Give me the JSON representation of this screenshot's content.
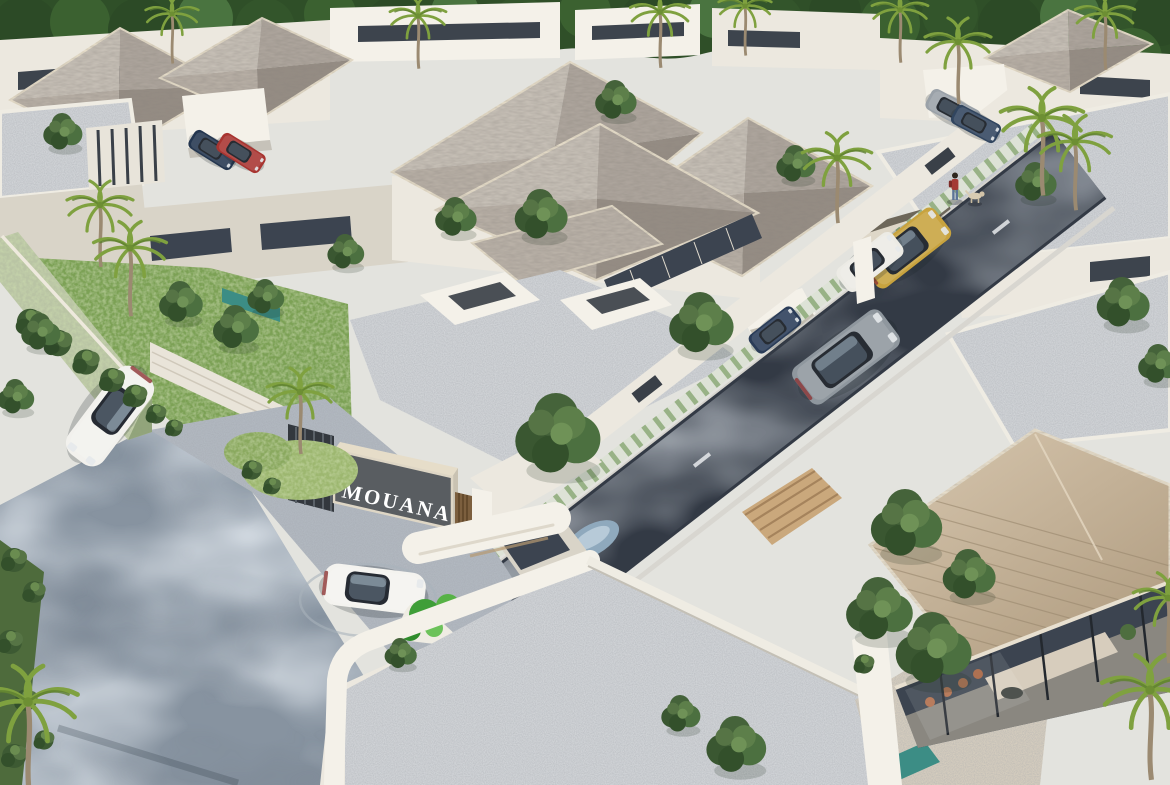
{
  "scene": {
    "title": "MOUANA",
    "type": "aerial 3D architectural rendering",
    "description": "Bird's-eye view of a gated tropical villa compound: modern white villas with grey shingle hip roofs and gravel flat roofs, a dark asphalt internal street with green-tiled sidewalk, a landscaped entrance gate with MOUANA sign and guard canopy, lawns, palms, trees and luxury cars."
  },
  "sign": {
    "text": "MOUANA"
  },
  "entities": {
    "entrance": "gate with dark slatted MOUANA sign panel, bronze louvre door, guard booth under rounded white canopy, bright green planter and circular paver pad",
    "street": "dark asphalt internal street with white lane dashes and green-white patterned sidewalk",
    "approach_road": "mottled blue-grey asphalt approach road at lower left with sculpted shrub balls and a green-mosaic feature wall",
    "villas": "modern white villas: grey shingle hip roofs, white-gravel flat roofs, floor-to-ceiling glass walls",
    "interior_view": "corner villa at lower right shows living room through glass: cream sofa, terracotta dining chairs, plants",
    "pedestrian": "person in red top with backpack walking a light-coloured dog on the sidewalk",
    "water": "teal-tiled pond strip beside left villa, small teal pool at lower right"
  },
  "cars": [
    {
      "type": "sport",
      "x": 110,
      "y": 416,
      "rot": 127,
      "s": 1.0,
      "color": "#f2f1ed",
      "label": "white sports car on approach road"
    },
    {
      "type": "sport",
      "x": 374,
      "y": 589,
      "rot": 7,
      "s": 0.95,
      "color": "#f4f3ef",
      "label": "white sports car at entrance gate"
    },
    {
      "type": "suv",
      "x": 846,
      "y": 357,
      "rot": -37,
      "s": 0.95,
      "color": "#8f979e",
      "label": "silver SUV driving on internal street"
    },
    {
      "type": "suv",
      "x": 906,
      "y": 248,
      "rot": -38,
      "s": 0.8,
      "color": "#c8a33e",
      "label": "gold SUV parked at villa entrance bay"
    },
    {
      "type": "sedan",
      "x": 870,
      "y": 262,
      "rot": -38,
      "s": 0.7,
      "color": "#ecebe5",
      "label": "white sedan beside gold SUV"
    },
    {
      "type": "sedan",
      "x": 775,
      "y": 330,
      "rot": -38,
      "s": 0.55,
      "color": "#2a3c58",
      "label": "dark car in mid carport"
    },
    {
      "type": "sedan",
      "x": 213,
      "y": 150,
      "rot": 32,
      "s": 0.5,
      "color": "#24364f",
      "label": "dark blue car in north carport"
    },
    {
      "type": "sedan",
      "x": 241,
      "y": 153,
      "rot": 32,
      "s": 0.5,
      "color": "#a83430",
      "label": "red car in north carport"
    },
    {
      "type": "sedan",
      "x": 953,
      "y": 110,
      "rot": 28,
      "s": 0.55,
      "color": "#9aa1a8",
      "label": "silver car in northeast carport"
    },
    {
      "type": "sedan",
      "x": 976,
      "y": 124,
      "rot": 28,
      "s": 0.5,
      "color": "#31455f",
      "label": "blue car in northeast carport"
    }
  ],
  "layout": {
    "trees": [
      [
        62,
        130,
        0.85
      ],
      [
        615,
        98,
        0.9
      ],
      [
        540,
        212,
        1.15
      ],
      [
        795,
        162,
        0.85
      ],
      [
        556,
        430,
        1.85
      ],
      [
        700,
        320,
        1.4
      ],
      [
        905,
        520,
        1.55
      ],
      [
        1122,
        300,
        1.15
      ],
      [
        1158,
        362,
        0.9
      ],
      [
        735,
        742,
        1.3
      ],
      [
        680,
        712,
        0.85
      ],
      [
        400,
        652,
        0.7
      ],
      [
        878,
        606,
        1.45
      ],
      [
        932,
        645,
        1.65
      ],
      [
        968,
        572,
        1.15
      ],
      [
        180,
        300,
        0.95
      ],
      [
        235,
        325,
        1.0
      ],
      [
        265,
        295,
        0.8
      ],
      [
        40,
        330,
        0.85
      ],
      [
        15,
        395,
        0.8
      ],
      [
        1035,
        180,
        0.9
      ],
      [
        345,
        250,
        0.8
      ],
      [
        455,
        215,
        0.9
      ]
    ],
    "palms": [
      [
        100,
        205,
        1.0
      ],
      [
        130,
        248,
        1.1
      ],
      [
        300,
        392,
        1.0
      ],
      [
        418,
        16,
        0.85
      ],
      [
        660,
        12,
        0.9
      ],
      [
        745,
        6,
        0.8
      ],
      [
        900,
        10,
        0.85
      ],
      [
        837,
        158,
        1.05
      ],
      [
        958,
        42,
        1.0
      ],
      [
        1042,
        118,
        1.25
      ],
      [
        1075,
        142,
        1.1
      ],
      [
        172,
        14,
        0.8
      ],
      [
        1105,
        14,
        0.9
      ],
      [
        28,
        702,
        1.5
      ],
      [
        1150,
        690,
        1.45
      ],
      [
        1168,
        598,
        1.05
      ]
    ],
    "bushes": [
      [
        30,
        322,
        1.1
      ],
      [
        58,
        343,
        1.1
      ],
      [
        86,
        362,
        1.05
      ],
      [
        112,
        380,
        1.0
      ],
      [
        135,
        396,
        0.95
      ],
      [
        156,
        414,
        0.8
      ],
      [
        174,
        428,
        0.7
      ],
      [
        14,
        560,
        1.0
      ],
      [
        34,
        592,
        0.9
      ],
      [
        10,
        642,
        1.0
      ],
      [
        26,
        700,
        0.9
      ],
      [
        14,
        756,
        1.0
      ],
      [
        44,
        740,
        0.8
      ],
      [
        252,
        470,
        0.8
      ],
      [
        272,
        486,
        0.7
      ],
      [
        864,
        664,
        0.8
      ]
    ]
  },
  "palette": {
    "bg": "#e3e3de",
    "forest": "#2f4f28",
    "wall": "#ece8df",
    "wall_bright": "#f4f1e9",
    "wall_shadow": "#d9d4c8",
    "fascia": "#e6ddc9",
    "roof_light": "#c6bfb6",
    "roof_dark": "#958d84",
    "roof_tan": "#cdbba2",
    "gravel": "#d4d7da",
    "asphalt": "#333a45",
    "approach": "#8793a0",
    "paver": "#b3bac2",
    "sidewalk": "#dde2d6",
    "sidewalk_green": "#82a26c",
    "glass": "#3c4450",
    "grass": "#7ba155",
    "hedge_wall": "#b9c4a4",
    "sign_panel": "#595d61",
    "sign_text": "#ffffff",
    "wood": "#7c5f3e",
    "planter": "#3f9e38",
    "pool": "#3c8d85",
    "sand": "#d9d0c0"
  }
}
